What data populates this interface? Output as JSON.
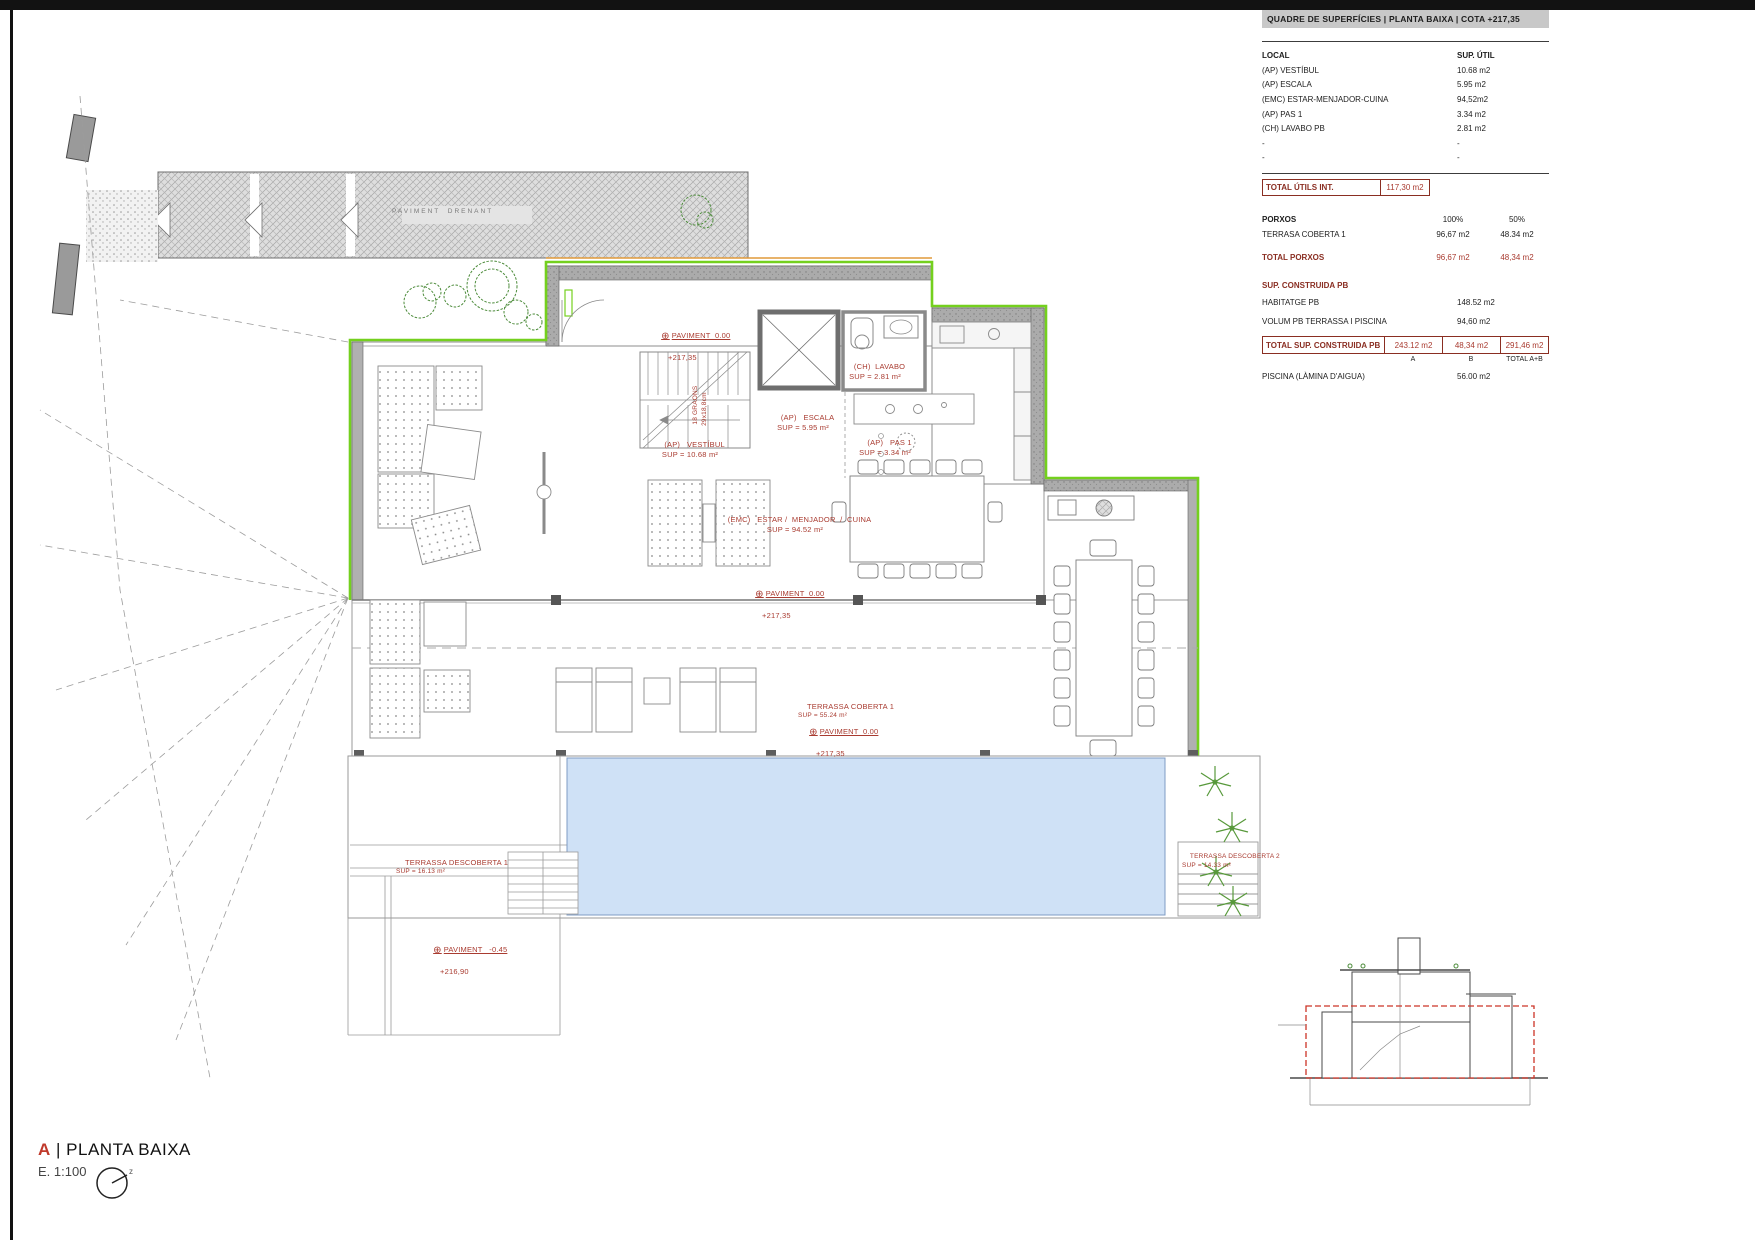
{
  "colors": {
    "accent_red": "#a93b30",
    "dark_red": "#8a2e22",
    "green_boundary": "#74d01e",
    "orange_line": "#e09a3a",
    "pool_blue": "#cfe1f6"
  },
  "panel": {
    "title": "QUADRE DE SUPERFÍCIES | PLANTA BAIXA | COTA +217,35",
    "col_local": "LOCAL",
    "col_sup": "SUP. ÚTIL",
    "rows": [
      {
        "local": "(AP) VESTÍBUL",
        "sup": "10.68 m2"
      },
      {
        "local": "(AP) ESCALA",
        "sup": "5.95 m2"
      },
      {
        "local": "(EMC) ESTAR-MENJADOR-CUINA",
        "sup": "94,52m2"
      },
      {
        "local": "(AP) PAS 1",
        "sup": "3.34 m2"
      },
      {
        "local": "(CH) LAVABO PB",
        "sup": "2.81 m2"
      },
      {
        "local": "-",
        "sup": "-"
      },
      {
        "local": "-",
        "sup": "-"
      }
    ],
    "total_utils_label": "TOTAL ÚTILS INT.",
    "total_utils_value": "117,30 m2",
    "porxos_label": "PORXOS",
    "porxos_col_a": "100%",
    "porxos_col_b": "50%",
    "porxos_row_label": "TERRASA COBERTA 1",
    "porxos_row_a": "96,67 m2",
    "porxos_row_b": "48.34 m2",
    "total_porxos_label": "TOTAL PORXOS",
    "total_porxos_a": "96,67 m2",
    "total_porxos_b": "48,34 m2",
    "construida_label": "SUP. CONSTRUIDA  PB",
    "construida_rows": [
      {
        "label": "HABITATGE PB",
        "value": "148.52 m2"
      },
      {
        "label": "VOLUM PB  TERRASSA I PISCINA",
        "value": "94,60 m2"
      }
    ],
    "total_construida_label": "TOTAL SUP. CONSTRUIDA  PB",
    "total_construida_a": "243.12 m2",
    "total_construida_b": "48,34 m2",
    "total_construida_ab": "291,46 m2",
    "note_a": "A",
    "note_b": "B",
    "note_ab": "TOTAL A+B",
    "piscina_label": "PISCINA (LÀMINA  D'AIGUA)",
    "piscina_value": "56.00 m2"
  },
  "plan": {
    "paviment_drenant": "PAVIMENT  DRENANT",
    "labels": {
      "pav_entry_1": "PAVIMENT  0.00",
      "pav_entry_2": "+217,35",
      "vestibul_1": "(AP)   VESTÍBUL",
      "vestibul_2": "SUP = 10.68 m²",
      "escala_1": "(AP)   ESCALA",
      "escala_2": "SUP = 5.95 m²",
      "graons_1": "18 GRAONS",
      "graons_2": "29x18,8cm",
      "pas_1": "(AP)   PAS 1",
      "pas_2": "SUP = 3.34 m²",
      "lavabo_1": "(CH)  LAVABO",
      "lavabo_2": "SUP = 2.81 m²",
      "emc_1": "(EMC)   ESTAR /  MENJADOR  /  CUINA",
      "emc_2": "SUP = 94.52 m²",
      "pav_main_1": "PAVIMENT  0.00",
      "pav_main_2": "+217,35",
      "ter_cob_1": "TERRASSA COBERTA 1",
      "ter_cob_2": "SUP = 55.24 m²",
      "pav_ter_1": "PAVIMENT  0.00",
      "pav_ter_2": "+217,35",
      "ter_d1_1": "TERRASSA DESCOBERTA 1",
      "ter_d1_2": "SUP = 16.13 m²",
      "pav_pool_1": "PAVIMENT   -0.45",
      "pav_pool_2": "+216,90",
      "ter_d2_1": "TERRASSA DESCOBERTA 2",
      "ter_d2_2": "SUP = 14.33 m²"
    }
  },
  "title_block": {
    "letter": "A",
    "separator": "| ",
    "title": "PLANTA BAIXA",
    "scale": "E. 1:100",
    "north_label": "z"
  }
}
